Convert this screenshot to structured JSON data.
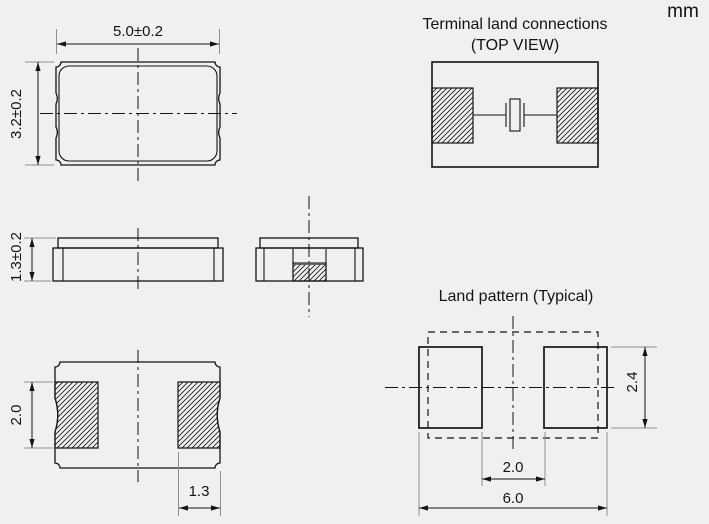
{
  "units_label": "mm",
  "colors": {
    "background": "#f0f0f0",
    "line": "#141414",
    "extension_line": "#8f8f8f",
    "hatch": "#141414"
  },
  "top_view": {
    "width_dim": "5.0±0.2",
    "height_dim": "3.2±0.2"
  },
  "side_view": {
    "thickness_dim": "1.3±0.2"
  },
  "bottom_view": {
    "pad_length_dim": "2.0",
    "pad_width_dim": "1.3"
  },
  "terminal_land_connections": {
    "title": "Terminal land connections",
    "subtitle": "(TOP VIEW)"
  },
  "land_pattern": {
    "title": "Land pattern (Typical)",
    "pad_height_dim": "2.4",
    "pad_gap_dim": "2.0",
    "overall_width_dim": "6.0"
  }
}
